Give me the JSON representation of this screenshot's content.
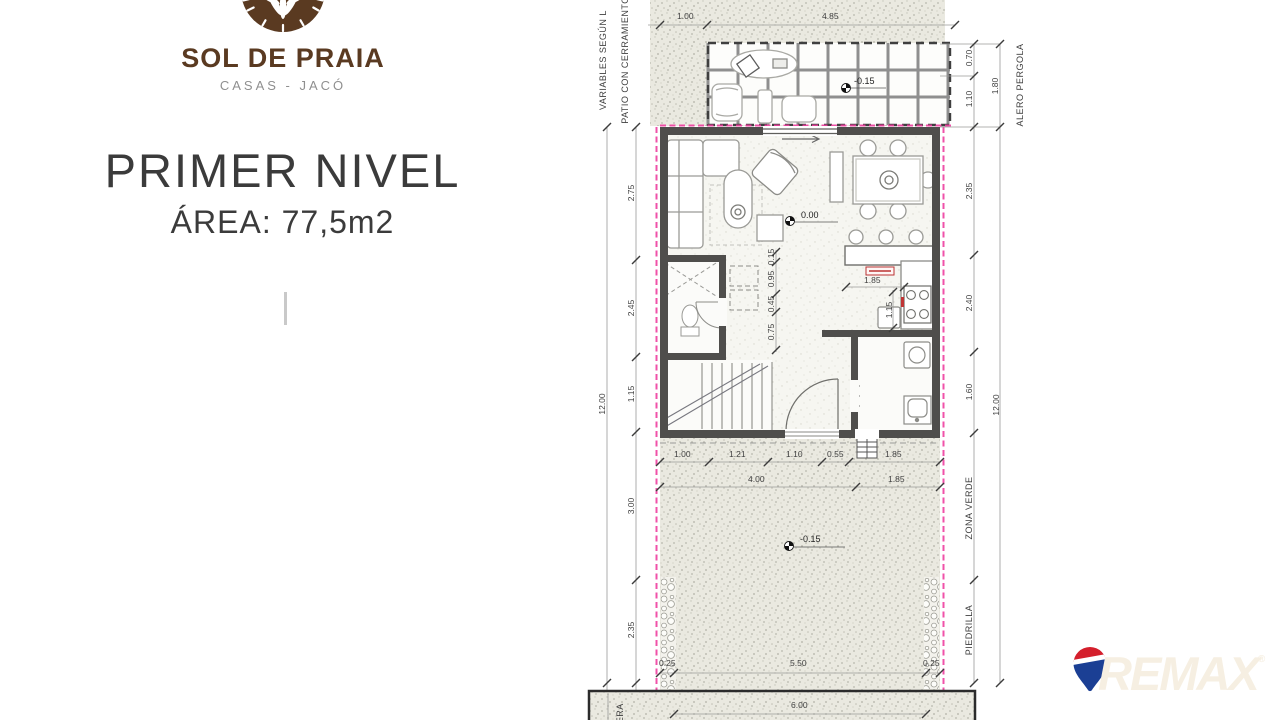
{
  "branding": {
    "logo_title": "SOL DE PRAIA",
    "logo_subtitle": "CASAS - JACÓ",
    "page_title": "PRIMER NIVEL",
    "page_subtitle": "ÁREA: 77,5m2",
    "brand_brown": "#5a3a21"
  },
  "remax": {
    "wordmark": "REMAX",
    "registered": "®",
    "balloon_red": "#d41f2c",
    "balloon_blue": "#1b3f94"
  },
  "plan": {
    "labels": {
      "variables_left": "VARIABLES SEGÚN L",
      "patio_left": "PATIO CON CERRAMIENTO",
      "alero_pergola": "ALERO PERGOLA",
      "zona_verde": "ZONA VERDE",
      "piedrilla": "PIEDRILLA",
      "acera": "ACERA"
    },
    "levels": {
      "pergola": "-0.15",
      "living": "0.00",
      "garden": "-0.15"
    },
    "dims": {
      "top": [
        "1.00",
        "4.85"
      ],
      "alero": [
        "0.70",
        "1.10",
        "1.80"
      ],
      "left": [
        "2.75",
        "2.45",
        "1.15",
        "3.00",
        "2.35",
        "12.00"
      ],
      "right": [
        "2.35",
        "2.40",
        "1.60",
        "12.00"
      ],
      "interior": [
        "0.15",
        "0.95",
        "0.45",
        "0.75"
      ],
      "kitchen": [
        "1.85",
        "1.15"
      ],
      "below1": [
        "1.00",
        "1.21",
        "1.10",
        "0.55",
        "1.85"
      ],
      "below2": [
        "4.00",
        "1.85"
      ],
      "bottom": [
        "0.25",
        "5.50",
        "0.25"
      ],
      "acera_width": "6.00"
    },
    "accent_pink": "#ee3fa0"
  }
}
